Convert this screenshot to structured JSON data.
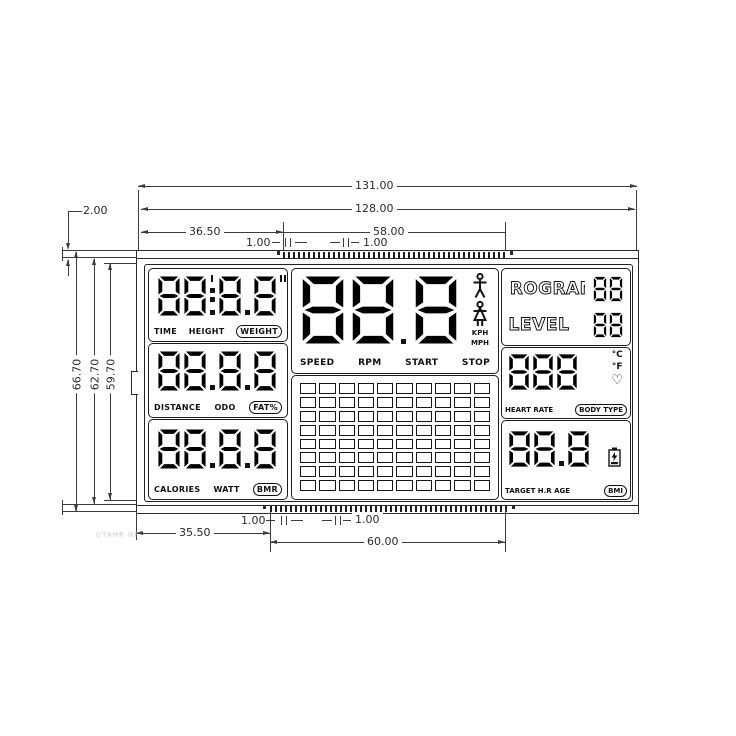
{
  "colors": {
    "line": "#3c3c3c",
    "ink": "#141414",
    "background": "#ffffff"
  },
  "dimensions": {
    "overall_width": "131.00",
    "inner_width": "128.00",
    "top_left_span": "36.50",
    "top_pad_span": "58.00",
    "top_pitch_left": "1.00",
    "top_pitch_right": "1.00",
    "corner_gap": "2.00",
    "heights": [
      "66.70",
      "62.70",
      "59.70"
    ],
    "bottom_left_span": "35.50",
    "bottom_pad_span": "60.00",
    "bottom_pitch_left": "1.00",
    "bottom_pitch_right": "1.00"
  },
  "watermark": "UTAHR HF",
  "lcd": {
    "time_cell": {
      "digits": "88|8.8\"",
      "labels": [
        "TIME",
        "HEIGHT"
      ],
      "boxed_label": "WEIGHT"
    },
    "distance_cell": {
      "digits": "88.8.8",
      "labels": [
        "DISTANCE",
        "ODO"
      ],
      "boxed_label": "FAT%"
    },
    "calories_cell": {
      "digits": "88.8.8",
      "labels": [
        "CALORIES",
        "WATT"
      ],
      "boxed_label": "BMR"
    },
    "speed_cell": {
      "digits": "88.8",
      "labels": [
        "SPEED",
        "RPM",
        "START",
        "STOP"
      ],
      "units": [
        "KPH",
        "MPH"
      ],
      "icons": [
        "male-figure",
        "female-figure"
      ]
    },
    "matrix_cell": {
      "columns": 10,
      "rows": 8
    },
    "program_row": {
      "label": "PROGRAM",
      "digits": "88"
    },
    "level_row": {
      "label": "LEVEL",
      "digits": "88"
    },
    "heart_cell": {
      "digits": "888",
      "units": [
        "°C",
        "°F"
      ],
      "label": "HEART RATE",
      "boxed_label": "BODY TYPE",
      "icon": "heart"
    },
    "target_cell": {
      "digits": "88.8",
      "label": "TARGET H.R AGE",
      "boxed_label": "BMI",
      "icon": "battery"
    }
  }
}
